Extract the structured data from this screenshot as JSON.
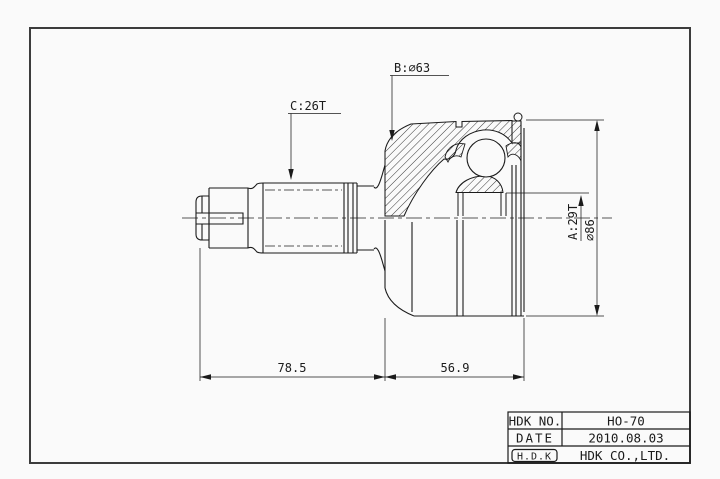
{
  "drawing": {
    "labels": {
      "outer_race_spline": "B:&#8709;63",
      "outer_race_spline_plain": "B:∅63",
      "shaft_spline": "C:26T",
      "inner_race_spline": "A:29T",
      "outer_diameter": "∅86",
      "shaft_length": "78.5",
      "joint_length": "56.9"
    },
    "title_block": {
      "no_label": "HDK NO.",
      "no_value": "HO-70",
      "date_label": "DATE",
      "date_value": "2010.08.03",
      "logo": "H.D.K",
      "company": "HDK CO.,LTD."
    },
    "colors": {
      "line": "#1b1b1b",
      "frame": "#3c3c3c",
      "paper": "#fafafa"
    }
  }
}
